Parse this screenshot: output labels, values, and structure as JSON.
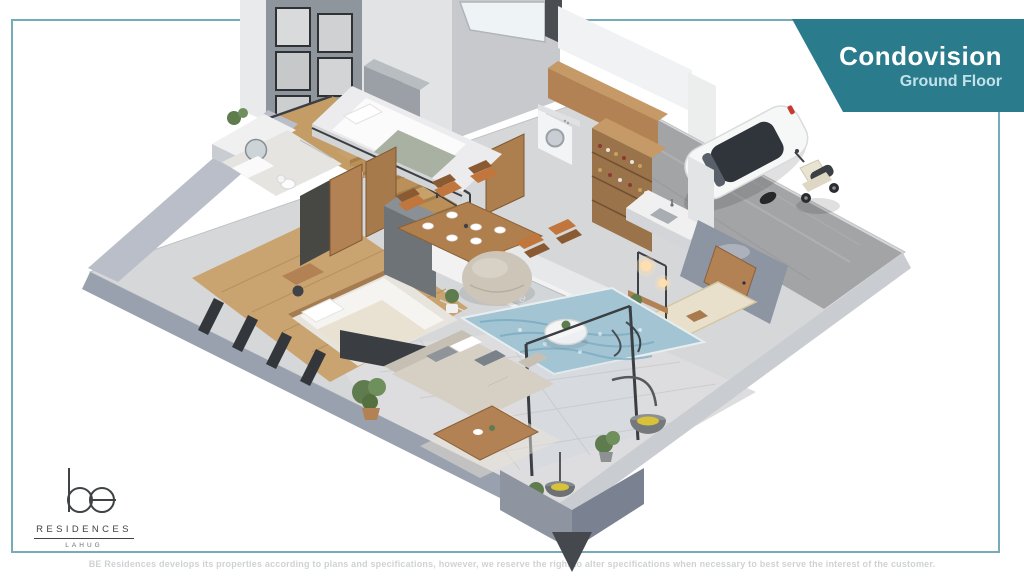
{
  "banner": {
    "title": "Condovision",
    "subtitle": "Ground Floor"
  },
  "logo": {
    "wordmark": "be",
    "line1": "RESIDENCES",
    "line2": "LAHUG"
  },
  "footer": {
    "disclaimer": "BE Residences develops its properties according to plans and specifications, however, we reserve the right to alter specifications when necessary to best serve the interest of the customer."
  },
  "floorplan": {
    "label": "3D isometric render of condominium ground floor unit",
    "tv_watermark": "be",
    "objects": [
      "gallery-wall",
      "skylight",
      "loft-bed",
      "staircase",
      "washing-machine",
      "kitchen-wine-shelving",
      "kitchen-counter-sink",
      "white-car",
      "scooter",
      "garage-slab",
      "entry-door",
      "doormat",
      "pendant-lights",
      "tv-media-wall",
      "dining-table-chairs",
      "bean-bag-pouf",
      "blue-area-rug",
      "round-coffee-table",
      "bathroom-vanity",
      "bedroom-bed",
      "wardrobe-doors",
      "patio-sectional-sofa",
      "patio-wood-table",
      "hanging-basket-chairs",
      "potted-plants",
      "glass-partition"
    ]
  },
  "colors": {
    "teal": "#2a7b8c",
    "banner-sub": "#c2e2ea",
    "frame": "#5e9cab",
    "disclaimer": "#cfd2d4",
    "ink": "#3f4346",
    "floor": "#d6d7d9",
    "concrete": "#a3a4a6",
    "patio": "#dddddf",
    "wood-floor": "#c9a470",
    "wood": "#b28254",
    "wall-light": "#f2f2f3",
    "wall-side": "#9aa1ae",
    "charcoal": "#3a3e43",
    "rug": "#a2c4d3",
    "sofa": "#d5cfc4",
    "plant": "#5e7c4e",
    "glow": "#ffdfae",
    "car": "#f6f7f7",
    "screen": "#d3d6d8",
    "chair": "#c0763c"
  }
}
